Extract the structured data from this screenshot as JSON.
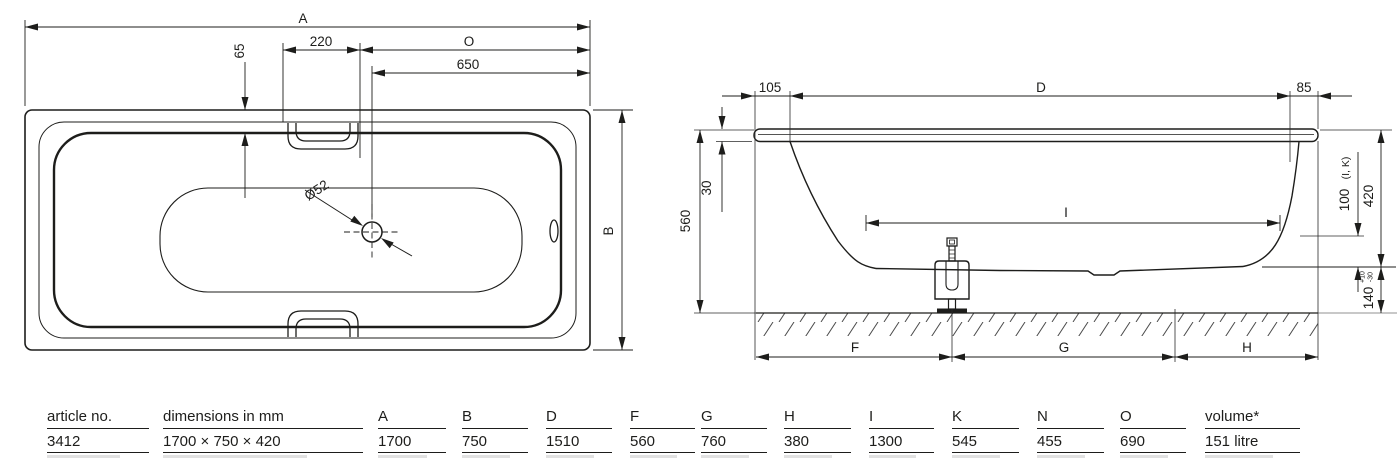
{
  "colors": {
    "line": "#1d1d1b",
    "hatch": "#4a4a4a"
  },
  "top_view": {
    "dim_a": "A",
    "dim_220": "220",
    "dim_o": "O",
    "dim_650": "650",
    "dim_65": "65",
    "dim_b": "B",
    "drain_diameter": "Ø52"
  },
  "side_view": {
    "dim_105": "105",
    "dim_d": "D",
    "dim_85": "85",
    "dim_30": "30",
    "dim_560": "560",
    "dim_i": "I",
    "dim_100": "100",
    "dim_100_ref": "(I, K)",
    "dim_420": "420",
    "dim_140": "140",
    "tol_plus": "+10",
    "tol_minus": "-30",
    "dim_f": "F",
    "dim_g": "G",
    "dim_h": "H"
  },
  "table": {
    "columns": [
      {
        "label": "article no.",
        "value": "3412"
      },
      {
        "label": "dimensions in mm",
        "value": "1700 × 750 × 420"
      },
      {
        "label": "A",
        "value": "1700"
      },
      {
        "label": "B",
        "value": "750"
      },
      {
        "label": "D",
        "value": "1510"
      },
      {
        "label": "F",
        "value": "560"
      },
      {
        "label": "G",
        "value": "760"
      },
      {
        "label": "H",
        "value": "380"
      },
      {
        "label": "I",
        "value": "1300"
      },
      {
        "label": "K",
        "value": "545"
      },
      {
        "label": "N",
        "value": "455"
      },
      {
        "label": "O",
        "value": "690"
      },
      {
        "label": "volume*",
        "value": "151 litre"
      }
    ]
  }
}
